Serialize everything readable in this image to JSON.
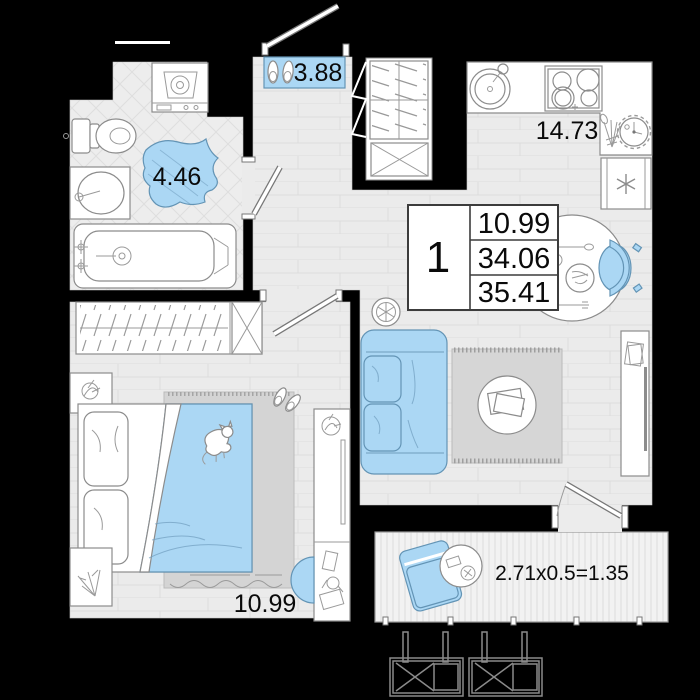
{
  "room_labels": {
    "hall": "3.88",
    "bathroom": "4.46",
    "kitchen_living": "14.73",
    "bedroom": "10.99"
  },
  "info_box": {
    "rooms_count": "1",
    "living_area": "10.99",
    "apartment_area": "34.06",
    "total_area": "35.41"
  },
  "balcony": {
    "dimension_formula": "2.71x0.5=1.35"
  },
  "colors": {
    "wall": "#000000",
    "floor": "#ebebeb",
    "bath_tile": "#ededed",
    "accent_blue": "#abd7f4",
    "rug_gray": "#d6d6d6",
    "outline_gray": "#8c8c8c"
  }
}
